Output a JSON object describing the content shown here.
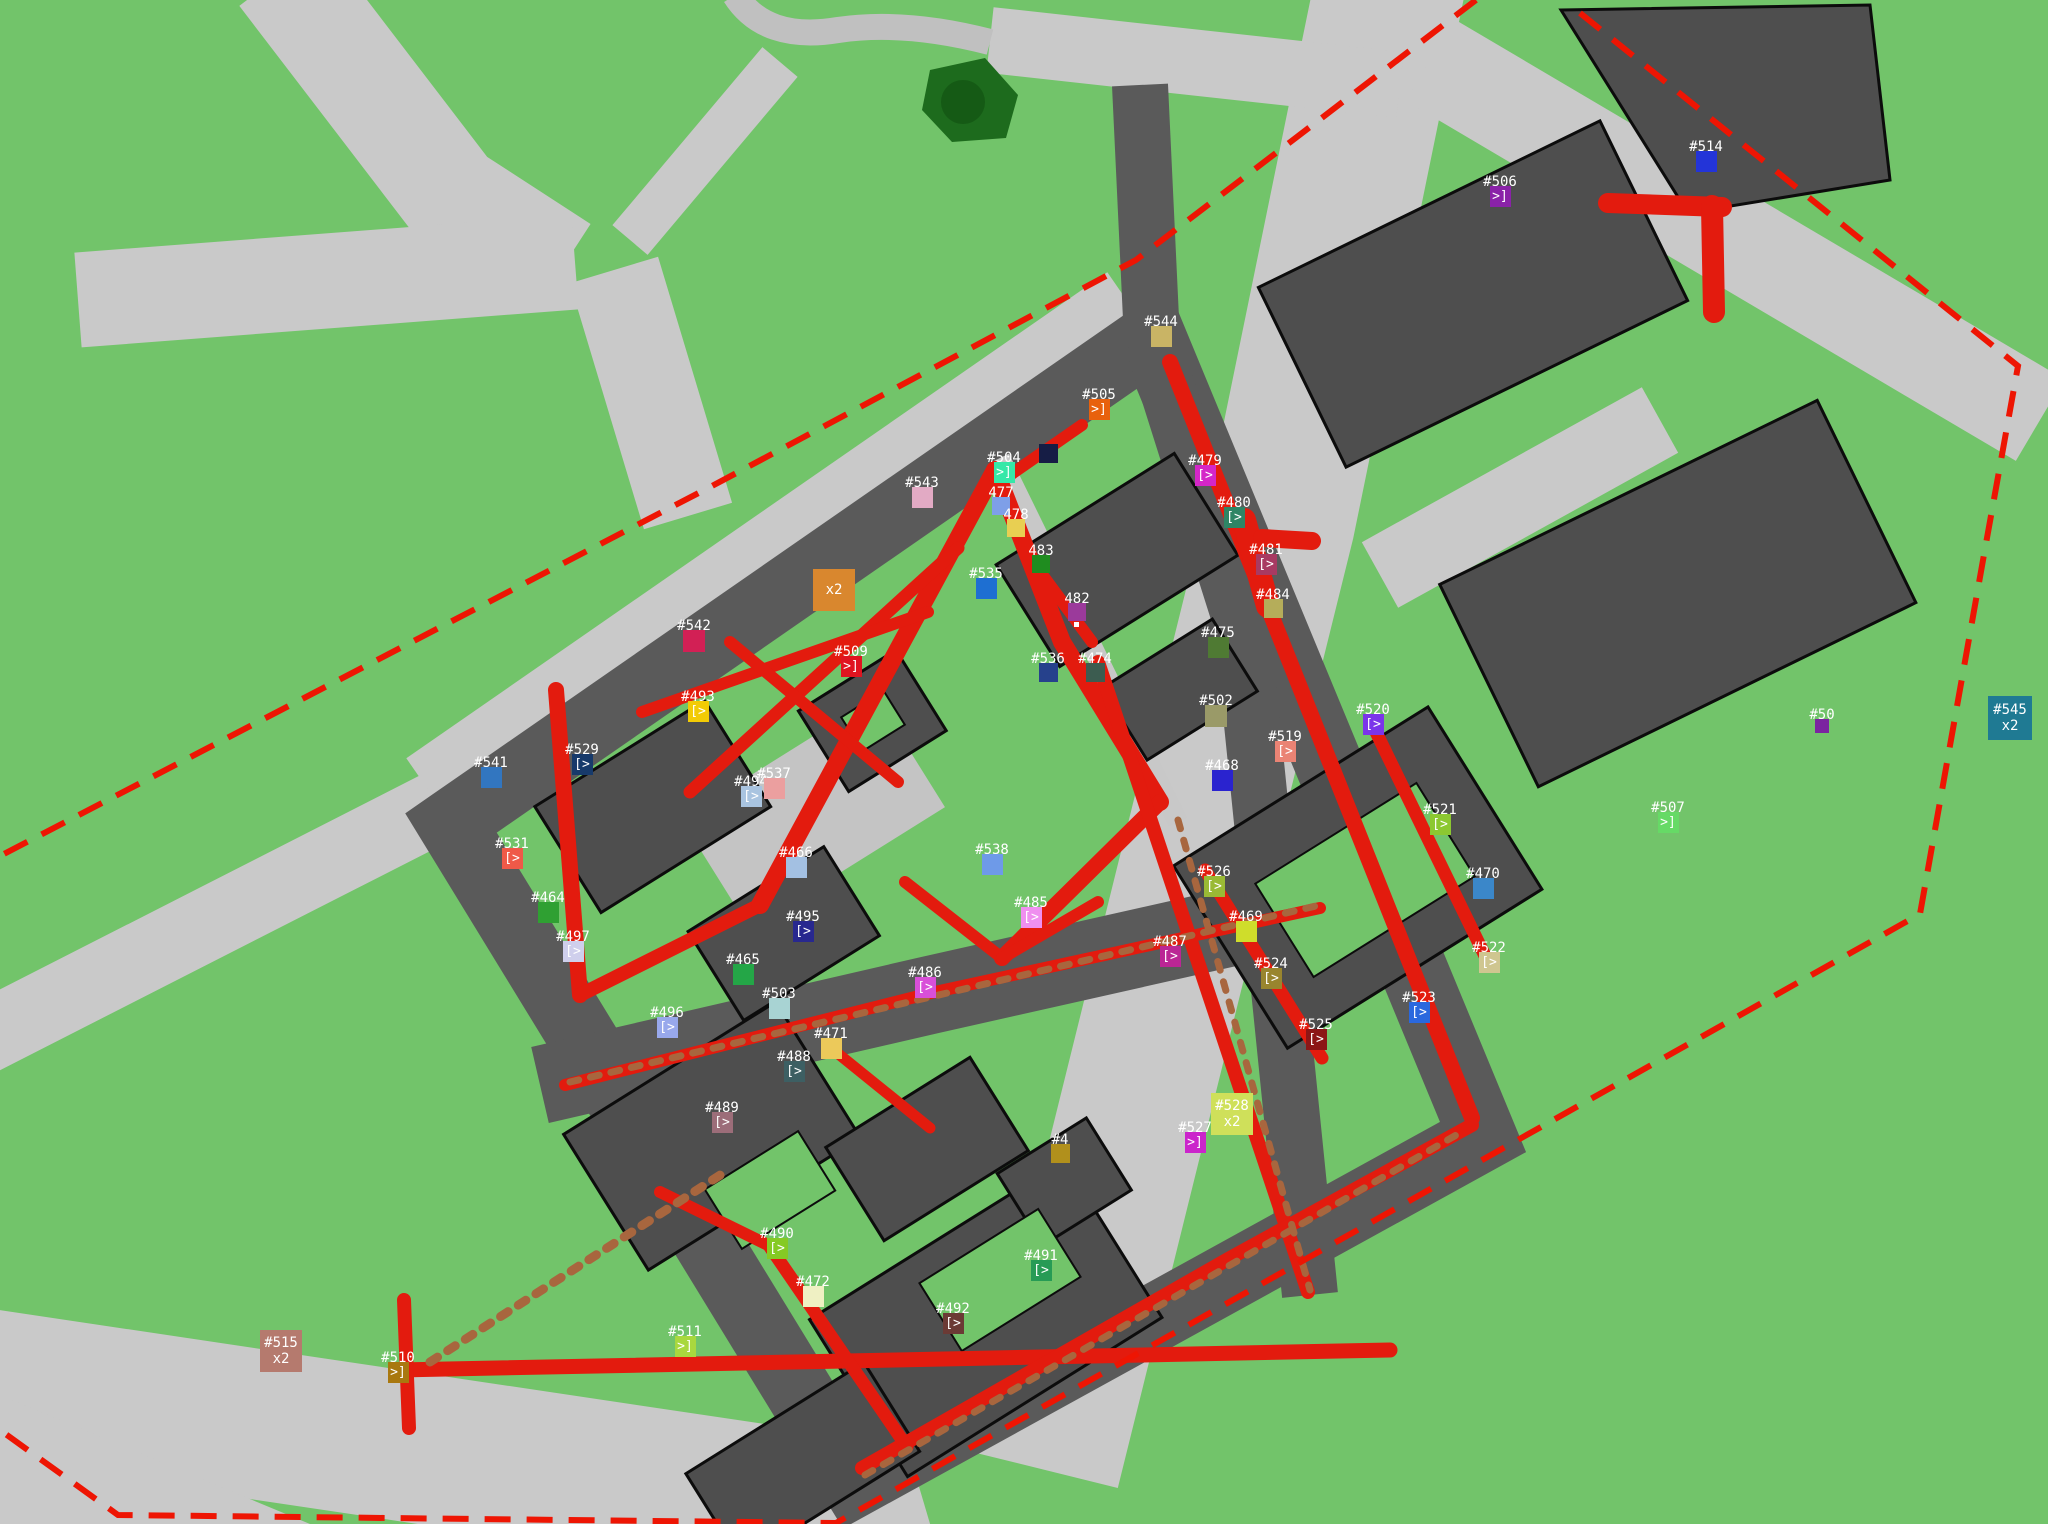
{
  "map": {
    "terrain_color": "#72c46a",
    "road_light_color": "#c9c9c9",
    "road_dark_color": "#5a5a5a",
    "building_color": "#4e4e4e",
    "trail_color": "#e31b0e",
    "dirt_trail_color": "#a8663e",
    "boundary_color": "#ee1503",
    "tree_color": "#1d6b1d",
    "boundary_style": "dashed"
  },
  "markers": [
    {
      "id": "506",
      "label": "#506",
      "glyph": ">]",
      "color": "#8a22a8",
      "x": 1500,
      "y": 196,
      "size": 21
    },
    {
      "id": "514",
      "label": "#514",
      "glyph": "",
      "color": "#2334d8",
      "x": 1706,
      "y": 161,
      "size": 21
    },
    {
      "id": "544",
      "label": "#544",
      "glyph": "",
      "color": "#c9b465",
      "x": 1161,
      "y": 336,
      "size": 21
    },
    {
      "id": "505",
      "label": "#505",
      "glyph": ">]",
      "color": "#e8610d",
      "x": 1099,
      "y": 409,
      "size": 21
    },
    {
      "id": "504",
      "label": "#504",
      "glyph": ">]",
      "color": "#35e8a8",
      "x": 1004,
      "y": 472,
      "size": 21
    },
    {
      "id": "543",
      "label": "#543",
      "glyph": "",
      "color": "#e2aac4",
      "x": 922,
      "y": 497,
      "size": 21
    },
    {
      "id": "477",
      "label": "477",
      "glyph": "",
      "color": "#7e9fe8",
      "x": 1001,
      "y": 506,
      "size": 18
    },
    {
      "id": "478",
      "label": "478",
      "glyph": "",
      "color": "#e8cf52",
      "x": 1016,
      "y": 528,
      "size": 18
    },
    {
      "id": "483",
      "label": "483",
      "glyph": "",
      "color": "#1f8c1f",
      "x": 1041,
      "y": 564,
      "size": 18
    },
    {
      "id": "535",
      "label": "#535",
      "glyph": "",
      "color": "#1e6fd2",
      "x": 986,
      "y": 588,
      "size": 21
    },
    {
      "id": "482",
      "label": "482",
      "glyph": "",
      "color": "#9b3a9b",
      "x": 1077,
      "y": 612,
      "size": 18
    },
    {
      "id": "482-dot",
      "label": "",
      "glyph": "",
      "color": "#ffffff",
      "x": 1076,
      "y": 624,
      "size": 5,
      "dot": true
    },
    {
      "id": "unlabeled",
      "label": "",
      "glyph": "",
      "color": "#161d45",
      "x": 1048,
      "y": 453,
      "size": 19
    },
    {
      "id": "479",
      "label": "#479",
      "glyph": "[>",
      "color": "#d426c8",
      "x": 1205,
      "y": 475,
      "size": 21
    },
    {
      "id": "480",
      "label": "#480",
      "glyph": "[>",
      "color": "#2e8565",
      "x": 1234,
      "y": 517,
      "size": 21
    },
    {
      "id": "481",
      "label": "#481",
      "glyph": "[>",
      "color": "#a83a62",
      "x": 1266,
      "y": 564,
      "size": 21
    },
    {
      "id": "484",
      "label": "#484",
      "glyph": "",
      "color": "#b5ad5a",
      "x": 1273,
      "y": 608,
      "size": 19
    },
    {
      "id": "475",
      "label": "#475",
      "glyph": "",
      "color": "#4f7a33",
      "x": 1218,
      "y": 647,
      "size": 21
    },
    {
      "id": "536",
      "label": "#536",
      "glyph": "",
      "color": "#26418c",
      "x": 1048,
      "y": 672,
      "size": 19
    },
    {
      "id": "474",
      "label": "#474",
      "glyph": "",
      "color": "#3c5c50",
      "x": 1095,
      "y": 672,
      "size": 19
    },
    {
      "id": "x2-orange",
      "label": "",
      "glyph": "",
      "badge": "x2",
      "color": "#d9872e",
      "x": 834,
      "y": 590,
      "size": 42
    },
    {
      "id": "542",
      "label": "#542",
      "glyph": "",
      "color": "#d22055",
      "x": 694,
      "y": 641,
      "size": 22
    },
    {
      "id": "509",
      "label": "#509",
      "glyph": ">]",
      "color": "#e01420",
      "x": 851,
      "y": 666,
      "size": 21
    },
    {
      "id": "493",
      "label": "#493",
      "glyph": "[>",
      "color": "#f2cb05",
      "x": 698,
      "y": 711,
      "size": 21
    },
    {
      "id": "541",
      "label": "#541",
      "glyph": "",
      "color": "#3276c0",
      "x": 491,
      "y": 777,
      "size": 21
    },
    {
      "id": "529",
      "label": "#529",
      "glyph": "[>",
      "color": "#173a6b",
      "x": 582,
      "y": 764,
      "size": 21
    },
    {
      "id": "494",
      "label": "#494",
      "glyph": "[>",
      "color": "#a9c4e0",
      "x": 751,
      "y": 796,
      "size": 21
    },
    {
      "id": "537",
      "label": "#537",
      "glyph": "",
      "color": "#eb9f9f",
      "x": 774,
      "y": 788,
      "size": 21
    },
    {
      "id": "531",
      "label": "#531",
      "glyph": "[>",
      "color": "#ef5948",
      "x": 512,
      "y": 858,
      "size": 21
    },
    {
      "id": "464",
      "label": "#464",
      "glyph": "",
      "color": "#2fa032",
      "x": 548,
      "y": 912,
      "size": 21
    },
    {
      "id": "466",
      "label": "#466",
      "glyph": "",
      "color": "#a3c0e2",
      "x": 796,
      "y": 867,
      "size": 21
    },
    {
      "id": "495",
      "label": "#495",
      "glyph": "[>",
      "color": "#28288f",
      "x": 803,
      "y": 931,
      "size": 21
    },
    {
      "id": "497",
      "label": "#497",
      "glyph": "[>",
      "color": "#cfcfec",
      "x": 573,
      "y": 951,
      "size": 21
    },
    {
      "id": "465",
      "label": "#465",
      "glyph": "",
      "color": "#24a647",
      "x": 743,
      "y": 974,
      "size": 21
    },
    {
      "id": "503",
      "label": "#503",
      "glyph": "",
      "color": "#a8d3d3",
      "x": 779,
      "y": 1008,
      "size": 21
    },
    {
      "id": "496",
      "label": "#496",
      "glyph": "[>",
      "color": "#98a8ec",
      "x": 667,
      "y": 1027,
      "size": 21
    },
    {
      "id": "538",
      "label": "#538",
      "glyph": "",
      "color": "#6e9ae8",
      "x": 992,
      "y": 864,
      "size": 21
    },
    {
      "id": "485",
      "label": "#485",
      "glyph": "[>",
      "color": "#ef8fef",
      "x": 1031,
      "y": 917,
      "size": 21
    },
    {
      "id": "486",
      "label": "#486",
      "glyph": "[>",
      "color": "#d94fd9",
      "x": 925,
      "y": 987,
      "size": 21
    },
    {
      "id": "487",
      "label": "#487",
      "glyph": "[>",
      "color": "#bb2695",
      "x": 1170,
      "y": 956,
      "size": 21
    },
    {
      "id": "502",
      "label": "#502",
      "glyph": "",
      "color": "#9a9a68",
      "x": 1216,
      "y": 716,
      "size": 22
    },
    {
      "id": "519",
      "label": "#519",
      "glyph": "[>",
      "color": "#ea8374",
      "x": 1285,
      "y": 751,
      "size": 21
    },
    {
      "id": "520",
      "label": "#520",
      "glyph": "[>",
      "color": "#7b35ea",
      "x": 1373,
      "y": 724,
      "size": 21
    },
    {
      "id": "468",
      "label": "#468",
      "glyph": "",
      "color": "#2a23cf",
      "x": 1222,
      "y": 780,
      "size": 21
    },
    {
      "id": "521",
      "label": "#521",
      "glyph": "[>",
      "color": "#8cc831",
      "x": 1440,
      "y": 824,
      "size": 21
    },
    {
      "id": "526",
      "label": "#526",
      "glyph": "[>",
      "color": "#9aba35",
      "x": 1214,
      "y": 886,
      "size": 21
    },
    {
      "id": "469",
      "label": "#469",
      "glyph": "",
      "color": "#cfdd2b",
      "x": 1246,
      "y": 931,
      "size": 21
    },
    {
      "id": "470",
      "label": "#470",
      "glyph": "",
      "color": "#3b87c9",
      "x": 1483,
      "y": 888,
      "size": 21
    },
    {
      "id": "524",
      "label": "#524",
      "glyph": "[>",
      "color": "#99852e",
      "x": 1271,
      "y": 978,
      "size": 21
    },
    {
      "id": "522",
      "label": "#522",
      "glyph": "[>",
      "color": "#cfc690",
      "x": 1489,
      "y": 962,
      "size": 21
    },
    {
      "id": "523",
      "label": "#523",
      "glyph": "[>",
      "color": "#2a68de",
      "x": 1419,
      "y": 1012,
      "size": 21
    },
    {
      "id": "525",
      "label": "#525",
      "glyph": "[>",
      "color": "#8c1616",
      "x": 1316,
      "y": 1039,
      "size": 21
    },
    {
      "id": "488",
      "label": "#488",
      "glyph": "[>",
      "color": "#3d5f63",
      "x": 794,
      "y": 1071,
      "size": 21
    },
    {
      "id": "471",
      "label": "#471",
      "glyph": "",
      "color": "#ecc95a",
      "x": 831,
      "y": 1048,
      "size": 21
    },
    {
      "id": "489",
      "label": "#489",
      "glyph": "[>",
      "color": "#9c6d79",
      "x": 722,
      "y": 1122,
      "size": 21
    },
    {
      "id": "4-truncated",
      "label": "#4",
      "glyph": "",
      "color": "#b1901c",
      "x": 1060,
      "y": 1153,
      "size": 19
    },
    {
      "id": "527",
      "label": "#527",
      "glyph": ">]",
      "color": "#cb24cb",
      "x": 1195,
      "y": 1142,
      "size": 21
    },
    {
      "id": "528",
      "label": "#528",
      "glyph": "",
      "badge": "x2",
      "color": "#cfe05a",
      "x": 1232,
      "y": 1114,
      "size": 42
    },
    {
      "id": "490",
      "label": "#490",
      "glyph": "[>",
      "color": "#85ca24",
      "x": 777,
      "y": 1248,
      "size": 21
    },
    {
      "id": "472",
      "label": "#472",
      "glyph": "",
      "color": "#eff0c3",
      "x": 813,
      "y": 1296,
      "size": 21
    },
    {
      "id": "491",
      "label": "#491",
      "glyph": "[>",
      "color": "#279b55",
      "x": 1041,
      "y": 1270,
      "size": 21
    },
    {
      "id": "492",
      "label": "#492",
      "glyph": "[>",
      "color": "#6b3a35",
      "x": 953,
      "y": 1323,
      "size": 21
    },
    {
      "id": "511",
      "label": "#511",
      "glyph": ">]",
      "color": "#a9d83e",
      "x": 685,
      "y": 1346,
      "size": 21
    },
    {
      "id": "510",
      "label": "#510",
      "glyph": ">]",
      "color": "#a9780f",
      "x": 398,
      "y": 1372,
      "size": 21
    },
    {
      "id": "515",
      "label": "#515",
      "glyph": "",
      "badge": "x2",
      "color": "#b57a6e",
      "x": 281,
      "y": 1351,
      "size": 42
    },
    {
      "id": "545",
      "label": "#545",
      "glyph": "",
      "badge": "x2",
      "color": "#1f7a93",
      "x": 2010,
      "y": 718,
      "size": 44
    },
    {
      "id": "507",
      "label": "#507",
      "glyph": ">]",
      "color": "#66da66",
      "x": 1668,
      "y": 822,
      "size": 21
    },
    {
      "id": "508-partial",
      "label": "#50",
      "glyph": "",
      "color": "#7b24a0",
      "x": 1822,
      "y": 726,
      "size": 14
    }
  ]
}
